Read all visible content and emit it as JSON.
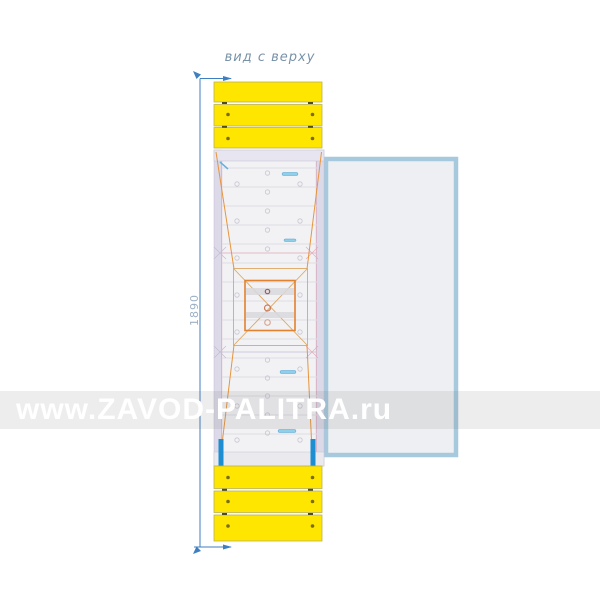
{
  "drawing": {
    "title": "вид с верху",
    "dimension_label": "1890",
    "colors": {
      "slat_yellow": "#FFE600",
      "construction_orange": "#E6953E",
      "dimension_blue": "#3D7FC1",
      "handrail_blue": "#1D8ED2",
      "slide_panel_border_blue": "#A6C9DD",
      "frame_lavender": "#DCD9E8"
    }
  },
  "watermark": {
    "text": "www.ZAVOD-PALITRA.ru"
  }
}
